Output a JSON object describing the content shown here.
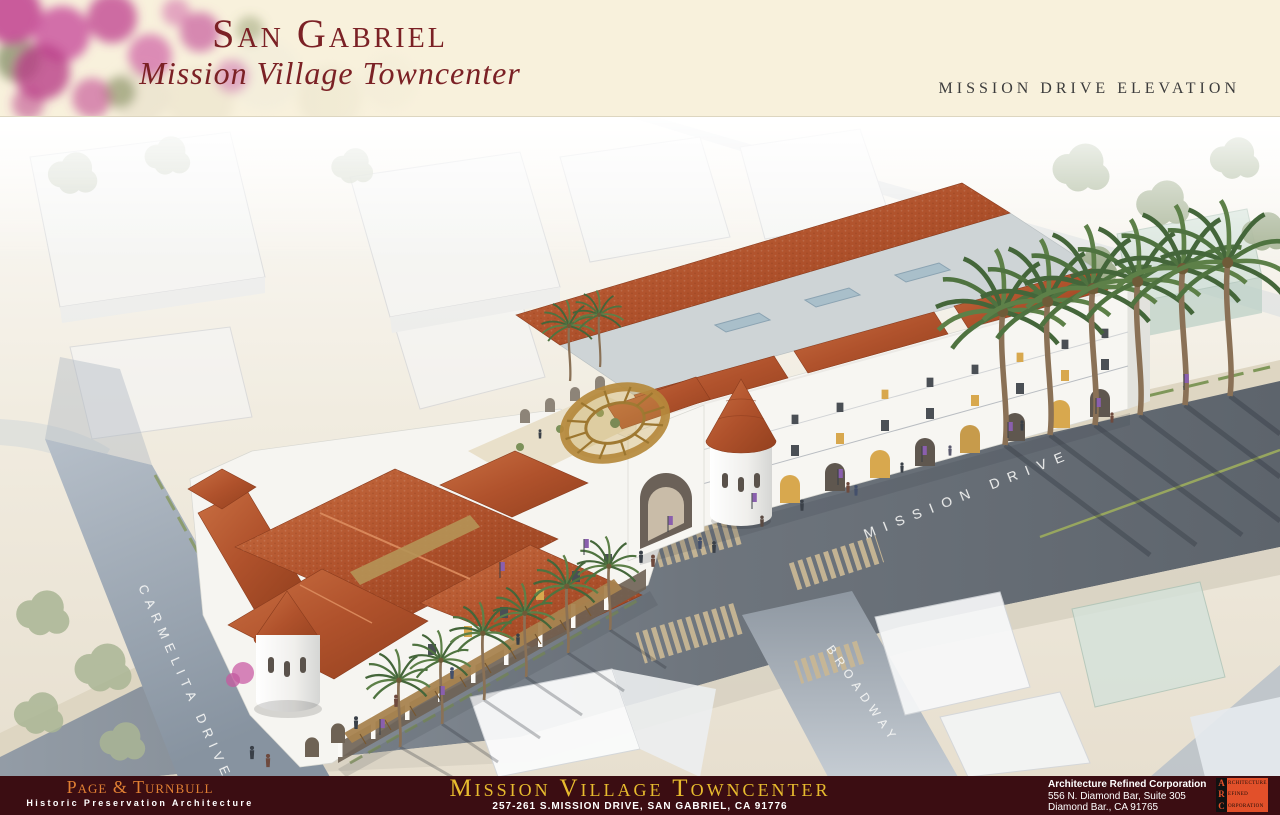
{
  "header": {
    "title_line1": "San Gabriel",
    "title_line2": "Mission Village Towncenter",
    "elevation_label": "MISSION DRIVE ELEVATION"
  },
  "rendering": {
    "street_labels": {
      "carmelita": "CARMELITA DRIVE",
      "mission": "MISSION DRIVE",
      "broadway": "BROADWAY"
    }
  },
  "footer": {
    "left": {
      "firm": "Page & Turnbull",
      "tagline": "Historic Preservation Architecture"
    },
    "center": {
      "project": "Mission Village Towncenter",
      "address": "257-261 S.MISSION DRIVE, SAN GABRIEL, CA 91776"
    },
    "right": {
      "line1": "Architecture Refined Corporation",
      "line2": "556 N. Diamond Bar, Suite 305",
      "line3": "Diamond Bar., CA 91765"
    },
    "logo": {
      "lines": [
        {
          "initial": "A",
          "rest": "rchitecture"
        },
        {
          "initial": "R",
          "rest": "efined"
        },
        {
          "initial": "C",
          "rest": "orporation"
        }
      ]
    }
  },
  "colors": {
    "header_bg": "#f8f1dc",
    "title_maroon": "#7b2125",
    "footer_maroon": "#3b0d12",
    "footer_orange": "#e07f33",
    "footer_gold": "#e7bb2e",
    "logo_orange": "#e2502a",
    "roof_terracotta": "#b0522c",
    "street_gray": "#5d646c",
    "bougainvillea_pink": "#c34a93"
  }
}
